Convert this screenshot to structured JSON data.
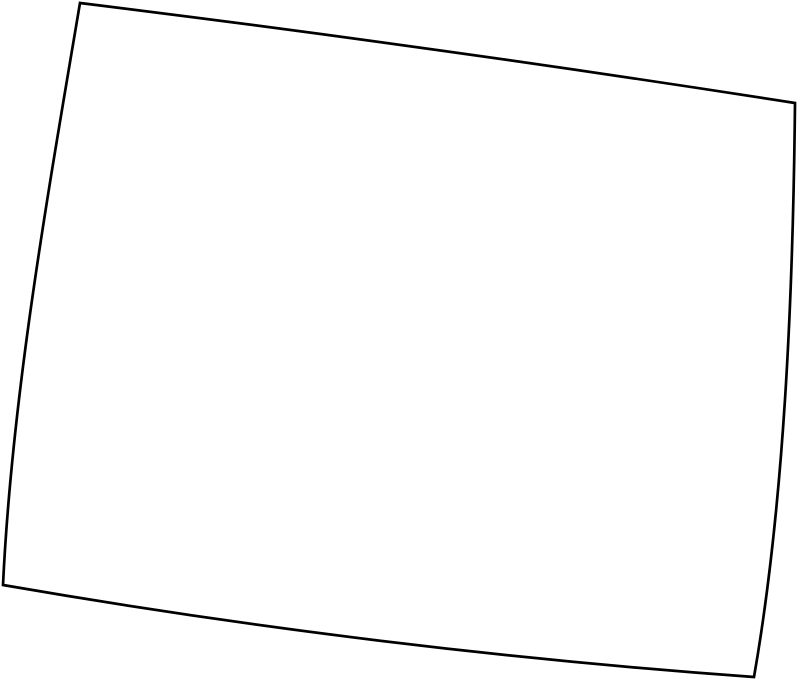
{
  "map": {
    "region": "Wyoming",
    "shape": "state-outline",
    "background_color": "#ffffff",
    "fill_color": "#ffffff",
    "stroke_color": "#000000",
    "stroke_width": 2.7,
    "outline_path": "M 80 3 Q 437 47 795 103 C 793 300 784 505 754 677 Q 378 650 3 585 C 12 395 48 193 80 3 Z",
    "corners": {
      "top_left": [
        80,
        3
      ],
      "top_right": [
        795,
        103
      ],
      "bottom_right": [
        754,
        677
      ],
      "bottom_left": [
        3,
        585
      ]
    }
  }
}
